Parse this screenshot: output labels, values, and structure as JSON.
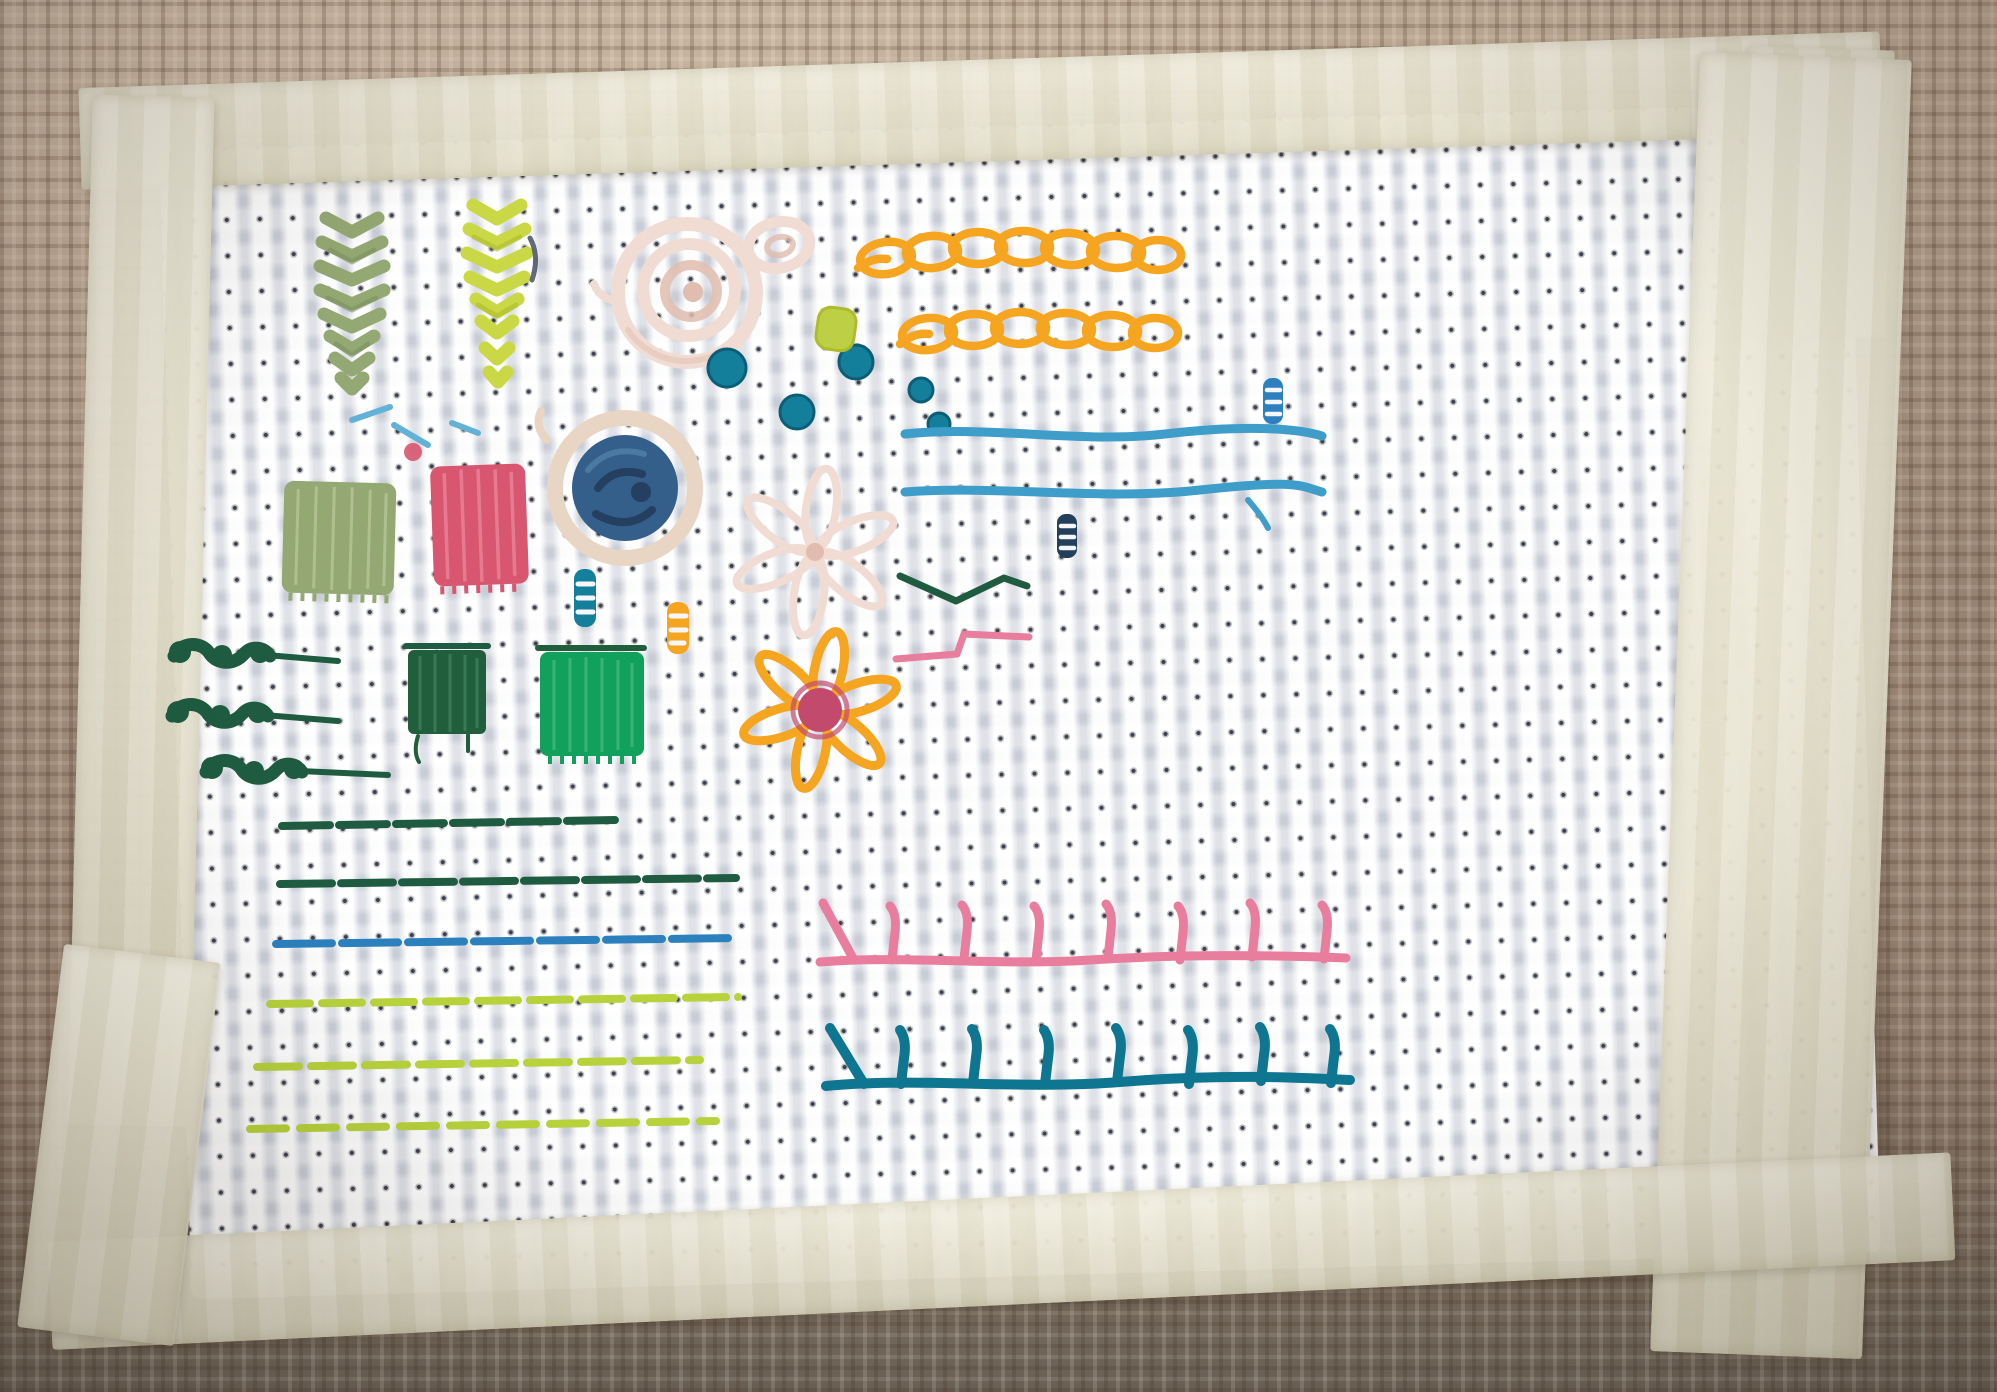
{
  "scene": {
    "type": "photograph",
    "subject": "Hand-embroidery stitch sampler practice piece",
    "ground_fabric": "white aida cross-stitch cloth",
    "mounting": "masking tape frame on all four edges",
    "backdrop": "tan woven burlap fabric"
  },
  "palette": {
    "burlap": "#a28c7a",
    "burlap_light": "#c2ae99",
    "burlap_grey": "#6f665b",
    "tape": "#ebe7d1",
    "aida": "#f4f5f7",
    "white_thread": "#f4f6f8",
    "sage": "#94a873",
    "sage_dark": "#79905c",
    "chartreuse": "#cbd845",
    "chartreuse_dark": "#aebc2c",
    "blush": "#f1dcd3",
    "blush_deep": "#e0bdae",
    "teal": "#147f9b",
    "teal_dark": "#0b5e76",
    "lime_leaf": "#bdcf45",
    "orange": "#f5a51f",
    "orange_deep": "#de8a06",
    "denim": "#335f8a",
    "denim_dark": "#24416366",
    "denim_deep": "#243f60",
    "denim_light": "#4d7ca3",
    "cream": "#e9d5c3",
    "emerald": "#12a15c",
    "forest": "#215e3c",
    "pine": "#1e5b40",
    "azure": "#62b2d8",
    "blue_line": "#2b80bd",
    "teal_line": "#3f9ec9",
    "lime_line": "#b8d23c",
    "rose_satin": "#d8566f",
    "rose_light": "#ea8ba0",
    "pink_row": "#e87d9d",
    "teal_row": "#0f7691",
    "magenta_center": "#c24a6c",
    "navy": "#22405c",
    "slate": "#3c465a"
  },
  "stitches": [
    {
      "name": "feather-stitch-leaf-sage",
      "technique": "feather stitch",
      "color": "#94a873"
    },
    {
      "name": "feather-stitch-leaf-chartreuse",
      "technique": "feather stitch",
      "color": "#cbd845"
    },
    {
      "name": "woven-wheel-rose",
      "technique": "woven wheel",
      "color": "#f1dcd3"
    },
    {
      "name": "blush-bullion-knot",
      "technique": "bullion knot",
      "color": "#f1dcd3"
    },
    {
      "name": "teal-french-knots",
      "technique": "french knots",
      "color": "#147f9b"
    },
    {
      "name": "lime-satin-leaf",
      "technique": "satin leaf",
      "color": "#bdcf45"
    },
    {
      "name": "orange-chain-stitch-rows",
      "technique": "chain stitch",
      "color": "#f5a51f"
    },
    {
      "name": "woven-circle-denim",
      "technique": "woven circle with couched rim",
      "color": "#335f8a"
    },
    {
      "name": "cream-lazy-daisy",
      "technique": "lazy daisy",
      "color": "#f1dcd3"
    },
    {
      "name": "whipped-straight-stitches",
      "technique": "whipped straight stitch",
      "color": "#147f9b"
    },
    {
      "name": "satin-block-sage",
      "technique": "satin stitch",
      "color": "#94a873"
    },
    {
      "name": "satin-block-pink",
      "technique": "satin stitch",
      "color": "#d8566f"
    },
    {
      "name": "satin-block-forest",
      "technique": "satin stitch",
      "color": "#215e3c"
    },
    {
      "name": "satin-block-emerald",
      "technique": "satin stitch",
      "color": "#12a15c"
    },
    {
      "name": "orange-daisy-flower",
      "technique": "lazy daisy with french knot center",
      "color": "#f5a51f"
    },
    {
      "name": "pine-knot-rows",
      "technique": "colonial knots",
      "color": "#1e5b40"
    },
    {
      "name": "running-stitch-lines",
      "technique": "running stitch",
      "color": "#1e5b40 / #2b80bd / #b8d23c"
    },
    {
      "name": "fly-stitch-accents",
      "technique": "fly stitch",
      "color": "#1e5b40 / #e87d9d"
    },
    {
      "name": "couched-lines-teal",
      "technique": "couching",
      "color": "#3f9ec9"
    },
    {
      "name": "blanket-stitch-pink",
      "technique": "blanket stitch",
      "color": "#e87d9d"
    },
    {
      "name": "blanket-stitch-teal",
      "technique": "blanket stitch",
      "color": "#0f7691"
    }
  ]
}
